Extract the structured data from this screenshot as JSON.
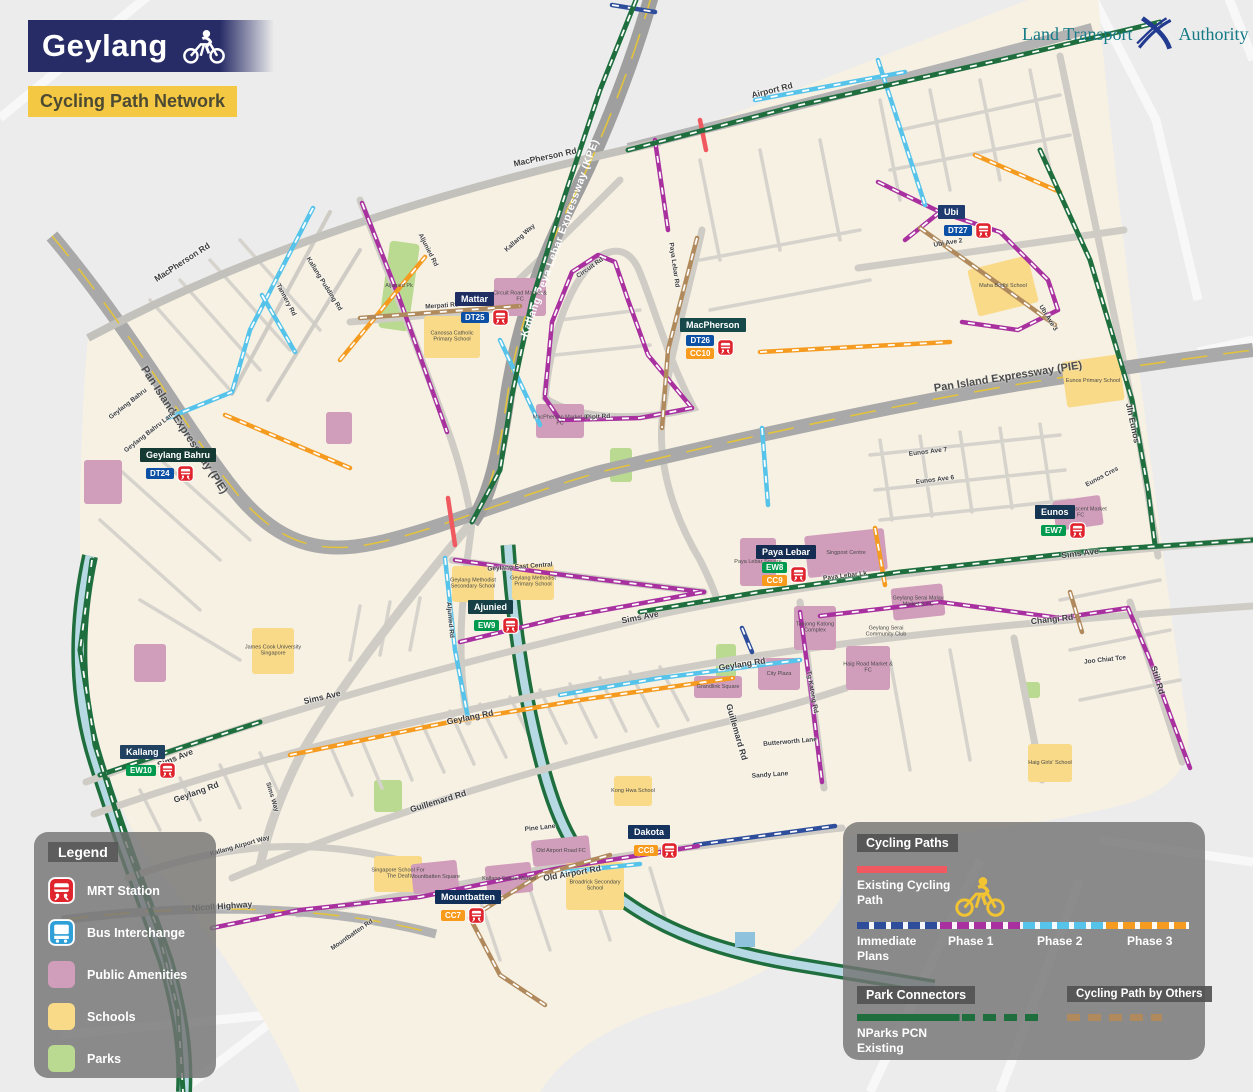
{
  "header": {
    "title": "Geylang",
    "subtitle": "Cycling Path Network"
  },
  "logo": {
    "left": "Land Transport",
    "right": "Authority"
  },
  "map_legend": {
    "title": "Legend",
    "items": [
      {
        "id": "mrt",
        "label": "MRT Station",
        "type": "mrt",
        "color": "#e0242d"
      },
      {
        "id": "bus",
        "label": "Bus Interchange",
        "type": "bus",
        "color": "#2f9fd8"
      },
      {
        "id": "amenities",
        "label": "Public Amenities",
        "type": "square",
        "color": "#d09dbb"
      },
      {
        "id": "schools",
        "label": "Schools",
        "type": "square",
        "color": "#f8da88"
      },
      {
        "id": "parks",
        "label": "Parks",
        "type": "square",
        "color": "#b9da90"
      }
    ]
  },
  "cycling_legend": {
    "title": "Cycling Paths",
    "existing_label": "Existing Cycling Path",
    "phases": [
      {
        "id": "immediate",
        "label": "Immediate Plans"
      },
      {
        "id": "phase1",
        "label": "Phase 1"
      },
      {
        "id": "phase2",
        "label": "Phase 2"
      },
      {
        "id": "phase3",
        "label": "Phase 3"
      }
    ],
    "park_title": "Park Connectors",
    "pcn_label": "NParks PCN Existing",
    "others_title": "Cycling Path by Others"
  },
  "colors": {
    "paths": {
      "existing": "#f0595f",
      "immediate": "#2e4d9b",
      "phase1": "#a8309f",
      "phase2": "#55c3ea",
      "phase3": "#f59b20",
      "pcn": "#1e6e3e",
      "others": "#b08a5c"
    },
    "lines": {
      "DT": "#0b50a4",
      "EW": "#009a4e",
      "CC": "#f89b1c"
    },
    "mrt_red": "#e0242d",
    "banner_navy": "#272c67",
    "banner_yellow": "#f5c844"
  },
  "map": {
    "stations": [
      {
        "name": "Mattar",
        "plate": "#1e2d62",
        "x": 455,
        "y": 292,
        "badges": [
          {
            "code": "DT25",
            "line": "DT"
          }
        ]
      },
      {
        "name": "MacPherson",
        "plate": "#17494a",
        "x": 680,
        "y": 318,
        "badges": [
          {
            "code": "DT26",
            "line": "DT"
          },
          {
            "code": "CC10",
            "line": "CC"
          }
        ]
      },
      {
        "name": "Ubi",
        "plate": "#1e3a6e",
        "x": 938,
        "y": 205,
        "badges": [
          {
            "code": "DT27",
            "line": "DT"
          }
        ]
      },
      {
        "name": "Geylang Bahru",
        "plate": "#153a34",
        "x": 140,
        "y": 448,
        "badges": [
          {
            "code": "DT24",
            "line": "DT"
          }
        ]
      },
      {
        "name": "Eunos",
        "plate": "#163552",
        "x": 1035,
        "y": 505,
        "badges": [
          {
            "code": "EW7",
            "line": "EW"
          }
        ]
      },
      {
        "name": "Paya Lebar",
        "plate": "#152c52",
        "x": 756,
        "y": 545,
        "badges": [
          {
            "code": "EW8",
            "line": "EW"
          },
          {
            "code": "CC9",
            "line": "CC"
          }
        ]
      },
      {
        "name": "Ajunied",
        "plate": "#163f46",
        "x": 468,
        "y": 600,
        "badges": [
          {
            "code": "EW9",
            "line": "EW"
          }
        ]
      },
      {
        "name": "Kallang",
        "plate": "#20415f",
        "x": 120,
        "y": 745,
        "badges": [
          {
            "code": "EW10",
            "line": "EW"
          }
        ]
      },
      {
        "name": "Dakota",
        "plate": "#16335e",
        "x": 628,
        "y": 825,
        "badges": [
          {
            "code": "CC8",
            "line": "CC"
          }
        ]
      },
      {
        "name": "Mountbatten",
        "plate": "#122f5a",
        "x": 435,
        "y": 890,
        "badges": [
          {
            "code": "CC7",
            "line": "CC"
          }
        ]
      }
    ],
    "road_labels": [
      {
        "text": "MacPherson Rd",
        "x": 545,
        "y": 157,
        "rot": -12,
        "cls": "med"
      },
      {
        "text": "MacPherson Rd",
        "x": 182,
        "y": 262,
        "rot": -33,
        "cls": "med"
      },
      {
        "text": "Airport Rd",
        "x": 772,
        "y": 90,
        "rot": -14,
        "cls": "med"
      },
      {
        "text": "Kallang Peya Lebar Expressway (KPE)",
        "x": 560,
        "y": 238,
        "rot": -70,
        "cls": "kpe"
      },
      {
        "text": "Pan Island Expressway (PIE)",
        "x": 184,
        "y": 430,
        "rot": 57,
        "cls": "pie"
      },
      {
        "text": "Pan Island Expressway (PIE)",
        "x": 1008,
        "y": 377,
        "rot": -9,
        "cls": "pie"
      },
      {
        "text": "Sims Ave",
        "x": 322,
        "y": 697,
        "rot": -13,
        "cls": "med"
      },
      {
        "text": "Sims Ave",
        "x": 640,
        "y": 617,
        "rot": -11,
        "cls": "med"
      },
      {
        "text": "Sims Ave",
        "x": 1080,
        "y": 553,
        "rot": -7,
        "cls": "med"
      },
      {
        "text": "Sims Ave",
        "x": 175,
        "y": 758,
        "rot": -22,
        "cls": "med"
      },
      {
        "text": "Geylang Rd",
        "x": 196,
        "y": 792,
        "rot": -20,
        "cls": "med"
      },
      {
        "text": "Geylang Rd",
        "x": 470,
        "y": 717,
        "rot": -11,
        "cls": "med"
      },
      {
        "text": "Geylang Rd",
        "x": 742,
        "y": 664,
        "rot": -9,
        "cls": "med"
      },
      {
        "text": "Guillemard Rd",
        "x": 438,
        "y": 801,
        "rot": -17,
        "cls": "med"
      },
      {
        "text": "Guillemard Rd",
        "x": 737,
        "y": 732,
        "rot": 74,
        "cls": "med"
      },
      {
        "text": "Changi Rd",
        "x": 1052,
        "y": 619,
        "rot": -6,
        "cls": "med"
      },
      {
        "text": "Still Rd",
        "x": 1158,
        "y": 680,
        "rot": 73,
        "cls": "med"
      },
      {
        "text": "Jln Eunos",
        "x": 1133,
        "y": 423,
        "rot": 78,
        "cls": "med"
      },
      {
        "text": "Paya Lebar Rd",
        "x": 674,
        "y": 265,
        "rot": 82
      },
      {
        "text": "Aljunied Rd",
        "x": 428,
        "y": 250,
        "rot": 63
      },
      {
        "text": "Aljunied Rd",
        "x": 450,
        "y": 620,
        "rot": 85
      },
      {
        "text": "Old Airport Rd",
        "x": 572,
        "y": 873,
        "rot": -10,
        "cls": "med"
      },
      {
        "text": "Nicoll Highway",
        "x": 222,
        "y": 906,
        "rot": -4,
        "cls": "med"
      },
      {
        "text": "Kallang Airport Way",
        "x": 240,
        "y": 846,
        "rot": -16
      },
      {
        "text": "Sims Way",
        "x": 272,
        "y": 797,
        "rot": 73
      },
      {
        "text": "Kallang Way",
        "x": 520,
        "y": 238,
        "rot": -42
      },
      {
        "text": "Merpati Rd",
        "x": 442,
        "y": 306,
        "rot": -4
      },
      {
        "text": "Circuit Rd",
        "x": 590,
        "y": 268,
        "rot": -35
      },
      {
        "text": "Pipit Rd",
        "x": 598,
        "y": 417,
        "rot": -3
      },
      {
        "text": "Tannery Rd",
        "x": 286,
        "y": 300,
        "rot": 62
      },
      {
        "text": "Kallang Pudding Rd",
        "x": 324,
        "y": 284,
        "rot": 58
      },
      {
        "text": "Geylang East Central",
        "x": 520,
        "y": 567,
        "rot": -4
      },
      {
        "text": "Geylang Bahru",
        "x": 128,
        "y": 404,
        "rot": -38
      },
      {
        "text": "Geylang Bahru Lane",
        "x": 150,
        "y": 432,
        "rot": -38
      },
      {
        "text": "Ubi Ave 2",
        "x": 948,
        "y": 243,
        "rot": -9
      },
      {
        "text": "Ubi Ave 3",
        "x": 1048,
        "y": 318,
        "rot": 58
      },
      {
        "text": "Eunos Cres",
        "x": 1102,
        "y": 477,
        "rot": -28
      },
      {
        "text": "Eunos Ave 7",
        "x": 928,
        "y": 452,
        "rot": -7
      },
      {
        "text": "Eunos Ave 6",
        "x": 935,
        "y": 480,
        "rot": -7
      },
      {
        "text": "Paya Lebar Lk",
        "x": 845,
        "y": 576,
        "rot": -7
      },
      {
        "text": "Joo Chiat Tce",
        "x": 1105,
        "y": 660,
        "rot": -6
      },
      {
        "text": "Tg Katong Rd",
        "x": 812,
        "y": 692,
        "rot": 80
      },
      {
        "text": "Pine Lane",
        "x": 540,
        "y": 828,
        "rot": -6
      },
      {
        "text": "Butterworth Lane",
        "x": 790,
        "y": 742,
        "rot": -5
      },
      {
        "text": "Sandy Lane",
        "x": 770,
        "y": 775,
        "rot": -4
      },
      {
        "text": "Mountbatten Rd",
        "x": 352,
        "y": 935,
        "rot": -35
      }
    ],
    "places": [
      {
        "text": "Circuit Road Market & FC",
        "x": 520,
        "y": 297
      },
      {
        "text": "MacPherson Market & FC",
        "x": 560,
        "y": 421
      },
      {
        "text": "Singpost Centre",
        "x": 846,
        "y": 553
      },
      {
        "text": "Paya Lebar Square",
        "x": 758,
        "y": 562
      },
      {
        "text": "Tanjong Katong Complex",
        "x": 815,
        "y": 628
      },
      {
        "text": "City Plaza",
        "x": 779,
        "y": 674
      },
      {
        "text": "Grandlink Square",
        "x": 718,
        "y": 687
      },
      {
        "text": "Haig Road Market & FC",
        "x": 868,
        "y": 668
      },
      {
        "text": "Geylang Serai Malay Market & FC",
        "x": 918,
        "y": 602
      },
      {
        "text": "Geylang Serai Community Club",
        "x": 886,
        "y": 632
      },
      {
        "text": "Eunos Crescent Market & FC",
        "x": 1078,
        "y": 513
      },
      {
        "text": "Old Airport Road FC",
        "x": 561,
        "y": 851
      },
      {
        "text": "Kallang Estate Market",
        "x": 509,
        "y": 879
      },
      {
        "text": "Mountbatten Square",
        "x": 435,
        "y": 877
      },
      {
        "text": "Canossa Catholic Primary School",
        "x": 452,
        "y": 337
      },
      {
        "text": "Maha Bodhi School",
        "x": 1003,
        "y": 286
      },
      {
        "text": "Eunos Primary School",
        "x": 1093,
        "y": 381
      },
      {
        "text": "Geylang Methodist Secondary School",
        "x": 473,
        "y": 584
      },
      {
        "text": "Geylang Methodist Primary School",
        "x": 533,
        "y": 582
      },
      {
        "text": "Broadrick Secondary School",
        "x": 595,
        "y": 886
      },
      {
        "text": "Kong Hwa School",
        "x": 633,
        "y": 791
      },
      {
        "text": "Singapore School For The Deaf",
        "x": 398,
        "y": 874
      },
      {
        "text": "James Cook University Singapore",
        "x": 273,
        "y": 651
      },
      {
        "text": "Haig Girls' School",
        "x": 1050,
        "y": 763
      },
      {
        "text": "Aljunied Pk",
        "x": 399,
        "y": 286
      }
    ],
    "cycle_paths": [
      {
        "phase": "existing",
        "points": "448,498 455,545"
      },
      {
        "phase": "existing",
        "points": "700,120 706,150"
      },
      {
        "phase": "immediate",
        "points": "695,845 835,826"
      },
      {
        "phase": "immediate",
        "points": "742,628 752,652"
      },
      {
        "phase": "immediate",
        "points": "612,5 655,12"
      },
      {
        "phase": "phase1",
        "points": "362,203 400,300 447,432"
      },
      {
        "phase": "phase1",
        "points": "545,395 552,322 572,272 598,255 615,262 628,300 648,355 692,408"
      },
      {
        "phase": "phase1",
        "points": "692,408 640,418 560,420 545,398"
      },
      {
        "phase": "phase1",
        "points": "455,560 540,572 620,582 704,592"
      },
      {
        "phase": "phase1",
        "points": "460,642 560,618 704,592"
      },
      {
        "phase": "phase1",
        "points": "820,616 940,602 1060,618 1128,608"
      },
      {
        "phase": "phase1",
        "points": "1128,608 1150,660 1172,720 1190,768"
      },
      {
        "phase": "phase1",
        "points": "878,182 940,212 1000,232 1048,280 1058,310 1018,330 962,322"
      },
      {
        "phase": "phase1",
        "points": "940,212 905,240"
      },
      {
        "phase": "phase1",
        "points": "655,140 668,230"
      },
      {
        "phase": "phase1",
        "points": "800,612 812,700 822,782"
      },
      {
        "phase": "phase1",
        "points": "212,928 300,910 420,897 560,868 698,846"
      },
      {
        "phase": "phase2",
        "points": "313,208 250,330 232,392"
      },
      {
        "phase": "phase2",
        "points": "262,295 295,352"
      },
      {
        "phase": "phase2",
        "points": "168,418 232,392"
      },
      {
        "phase": "phase2",
        "points": "445,558 455,650 468,718"
      },
      {
        "phase": "phase2",
        "points": "560,695 660,678 800,660"
      },
      {
        "phase": "phase2",
        "points": "563,872 640,864"
      },
      {
        "phase": "phase2",
        "points": "878,60 925,205"
      },
      {
        "phase": "phase2",
        "points": "755,100 905,72"
      },
      {
        "phase": "phase2",
        "points": "762,428 768,505"
      },
      {
        "phase": "phase2",
        "points": "500,340 540,425"
      },
      {
        "phase": "phase3",
        "points": "340,360 425,257"
      },
      {
        "phase": "phase3",
        "points": "225,415 350,468"
      },
      {
        "phase": "phase3",
        "points": "760,352 950,342"
      },
      {
        "phase": "phase3",
        "points": "975,155 1060,192"
      },
      {
        "phase": "phase3",
        "points": "290,755 450,722 580,700 733,678"
      },
      {
        "phase": "phase3",
        "points": "875,528 885,585"
      },
      {
        "phase": "others",
        "points": "360,318 520,306"
      },
      {
        "phase": "others",
        "points": "697,238 668,350 662,428"
      },
      {
        "phase": "others",
        "points": "920,228 1000,285 1055,325"
      },
      {
        "phase": "others",
        "points": "470,918 540,875 610,855"
      },
      {
        "phase": "others",
        "points": "470,918 500,975 545,1005"
      },
      {
        "phase": "others",
        "points": "1070,592 1082,632"
      },
      {
        "phase": "pcn",
        "points": "636,0 600,90 565,195 532,300 512,395 500,470 472,522"
      },
      {
        "phase": "pcn",
        "points": "628,150 800,105 1000,60 1160,22"
      },
      {
        "phase": "pcn",
        "points": "1040,150 1090,260 1132,400 1148,490 1155,545"
      },
      {
        "phase": "pcn",
        "points": "640,612 760,592 900,572 1100,550 1253,540"
      },
      {
        "phase": "pcn",
        "points": "100,775 180,748 260,722"
      },
      {
        "phase": "pcn",
        "points": "92,560 80,650 95,745 125,840 158,930 178,1010 183,1092"
      }
    ]
  }
}
